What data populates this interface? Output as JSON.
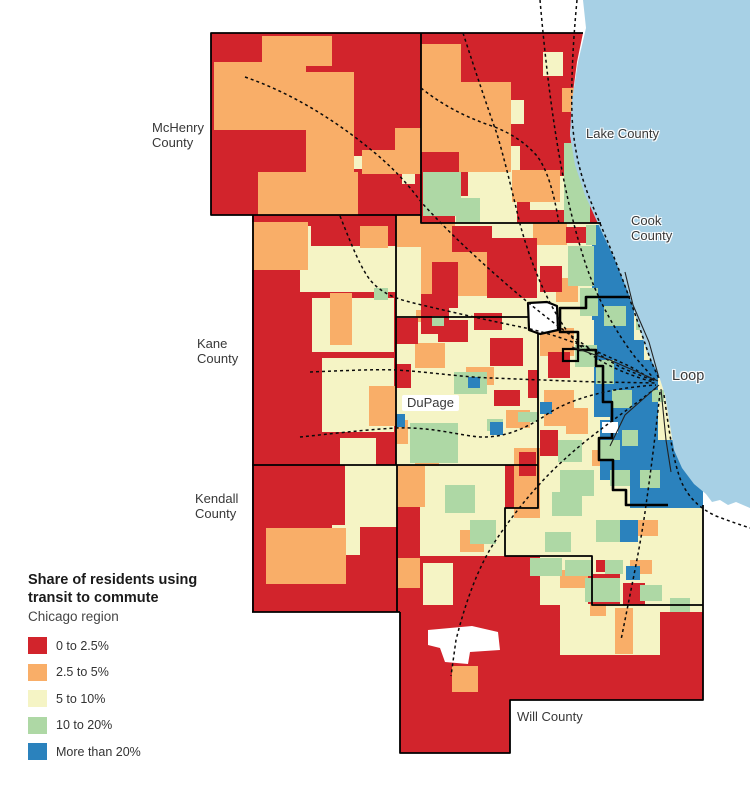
{
  "palette": {
    "cat1": "#d2242c",
    "cat2": "#f9ae68",
    "cat3": "#f5f4c5",
    "cat4": "#aed8a5",
    "cat5": "#2b82bd",
    "lake": "#a7d0e5",
    "boundary": "#000000"
  },
  "legend": {
    "title_line1": "Share of residents using",
    "title_line2": "transit to commute",
    "subtitle": "Chicago region",
    "items": [
      {
        "label": "0 to 2.5%",
        "color": "#d2242c"
      },
      {
        "label": "2.5 to 5%",
        "color": "#f9ae68"
      },
      {
        "label": "5 to 10%",
        "color": "#f5f4c5"
      },
      {
        "label": "10 to 20%",
        "color": "#aed8a5"
      },
      {
        "label": "More than 20%",
        "color": "#2b82bd"
      }
    ]
  },
  "map_labels": {
    "mchenry": {
      "line1": "McHenry",
      "line2": "County"
    },
    "lake": {
      "line1": "Lake County"
    },
    "cook": {
      "line1": "Cook",
      "line2": "County"
    },
    "kane": {
      "line1": "Kane",
      "line2": "County"
    },
    "dupage": {
      "line1": "DuPage"
    },
    "kendall": {
      "line1": "Kendall",
      "line2": "County"
    },
    "loop": {
      "line1": "Loop"
    },
    "will": {
      "line1": "Will County"
    }
  }
}
